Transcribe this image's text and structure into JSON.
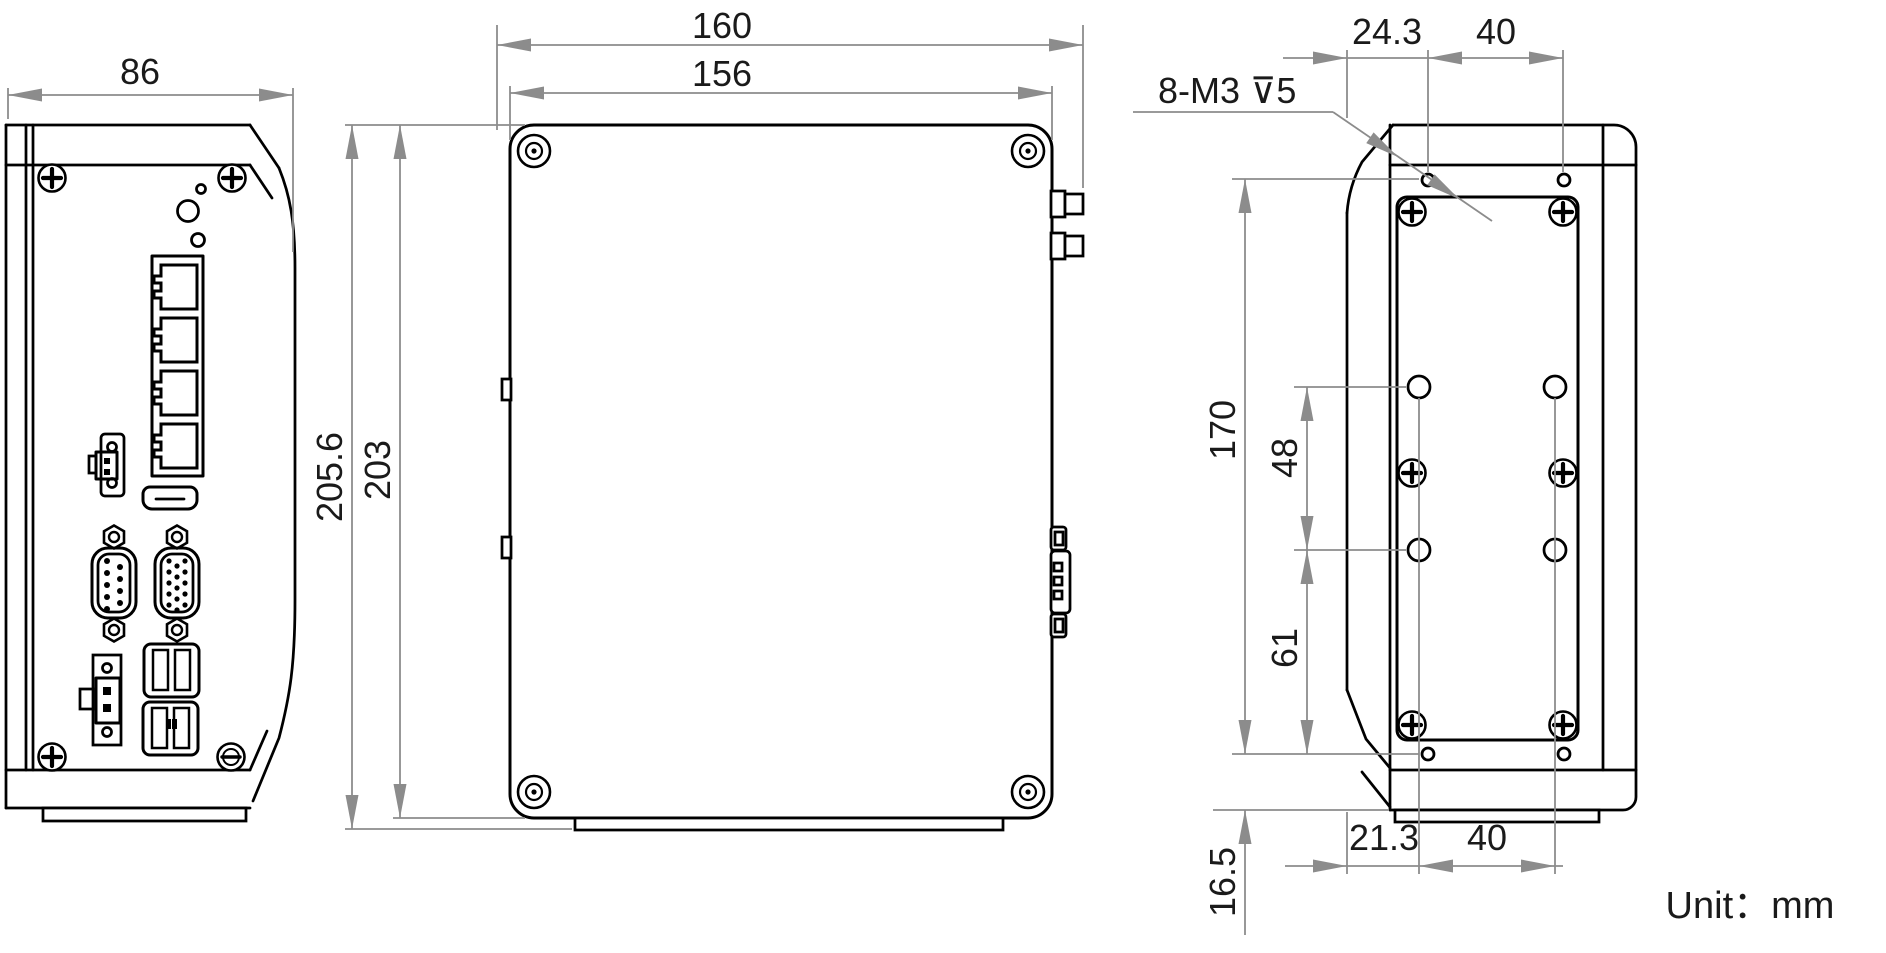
{
  "drawing": {
    "unit_note": "Unit：mm",
    "front_view": {
      "dim_width": "86",
      "features": [
        "corner-screws",
        "status-leds",
        "ethernet-ports-x4",
        "terminal-block-2pin",
        "hdmi-port",
        "db9-serial-port",
        "vga-port",
        "power-connector",
        "usb-ports",
        "ground-screw"
      ]
    },
    "side_view": {
      "dim_overall_width": "160",
      "dim_body_width": "156",
      "dim_overall_height": "205.6",
      "dim_body_height": "203",
      "features": [
        "corner-screws",
        "antenna-connectors",
        "side-db-connector",
        "mounting-foot"
      ]
    },
    "rear_view": {
      "thread_note": "8-M3 ⊽5",
      "dim_top_offset": "24.3",
      "dim_top_spacing": "40",
      "dim_hole_span": "170",
      "dim_mid_spacing": "48",
      "dim_lower_spacing": "61",
      "dim_bottom_offset": "21.3",
      "dim_bottom_spacing": "40",
      "dim_foot_offset": "16.5",
      "features": [
        "mounting-holes-8xM3-depth5",
        "panel-screws",
        "locating-holes"
      ]
    },
    "colors": {
      "outline": "#000000",
      "dimension_lines": "#8c8c8c",
      "text": "#1a1a1a",
      "background": "#ffffff"
    }
  }
}
